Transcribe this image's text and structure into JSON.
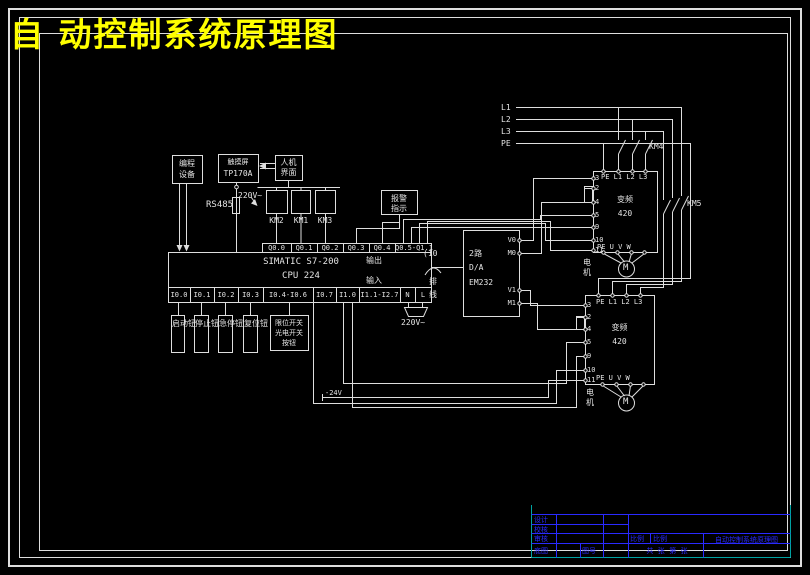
{
  "title": "自 动控制系统原理图",
  "top_devices": {
    "programmer": {
      "line1": "编程",
      "line2": "设备"
    },
    "touch_panel": {
      "line1": "触摸屏",
      "line2": "TP170A"
    },
    "hmi": {
      "line1": "人机",
      "line2": "界面"
    },
    "bus": "RS485",
    "panel_supply": "220V~"
  },
  "relays": {
    "coil1": "KM2",
    "coil2": "KM1",
    "coil3": "KM3",
    "alarm_line1": "报警",
    "alarm_line2": "指示"
  },
  "plc": {
    "model_line1": "SIMATIC S7-200",
    "model_line2": "CPU 224",
    "label_out": "输出",
    "label_in": "输入",
    "outputs": [
      "Q0.0",
      "Q0.1",
      "Q0.2",
      "Q0.3",
      "Q0.4",
      "Q0.5-Q1.1"
    ],
    "inputs": [
      "I0.0",
      "I0.1",
      "I0.2",
      "I0.3",
      "I0.4-I0.6",
      "I0.7",
      "I1.0",
      "I1.1-I2.7",
      "N",
      "L"
    ],
    "ac_supply": "220V~"
  },
  "input_devices": {
    "box1": "启动钮",
    "box2": "停止钮",
    "box3": "急停钮",
    "box4": "复位钮",
    "box5_line1": "限位开关",
    "box5_line2": "光电开关",
    "box5_line3": "按钮"
  },
  "analog_module": {
    "channels": "2路",
    "func": "D/A",
    "model": "EM232",
    "t_v0": "V0",
    "t_m0": "M0",
    "t_v1": "V1",
    "t_m1": "M1",
    "cable": "(10",
    "cable_note1": "排",
    "cable_note2": "线"
  },
  "power": {
    "l1": "L1",
    "l2": "L2",
    "l3": "L3",
    "pe": "PE",
    "km4": "KM4",
    "km5": "KM5",
    "dc": "-24V"
  },
  "converter1": {
    "top_terminals": "PE L1 L2 L3",
    "name_line1": "变频",
    "name_line2": "420",
    "bottom_terminals": "PE U V W",
    "terminals": [
      "3",
      "2",
      "4",
      "5",
      "9",
      "10",
      "11"
    ],
    "motor": "M",
    "motor_label_1": "电",
    "motor_label_2": "机"
  },
  "converter2": {
    "top_terminals": "PE L1 L2 L3",
    "name_line1": "变频",
    "name_line2": "420",
    "bottom_terminals": "PE U V W",
    "terminals": [
      "3",
      "2",
      "4",
      "5",
      "9",
      "10",
      "11"
    ],
    "motor": "M",
    "motor_label_1": "电",
    "motor_label_2": "机"
  },
  "titleblock": {
    "row1": "设计",
    "row2": "校核",
    "row3": "审核",
    "row4": "底图",
    "drawing_no": "图号",
    "scale_left": "比例",
    "scale_right": "比例",
    "sheet": "共  张  第  张",
    "title": "自动控制系统原理图"
  }
}
